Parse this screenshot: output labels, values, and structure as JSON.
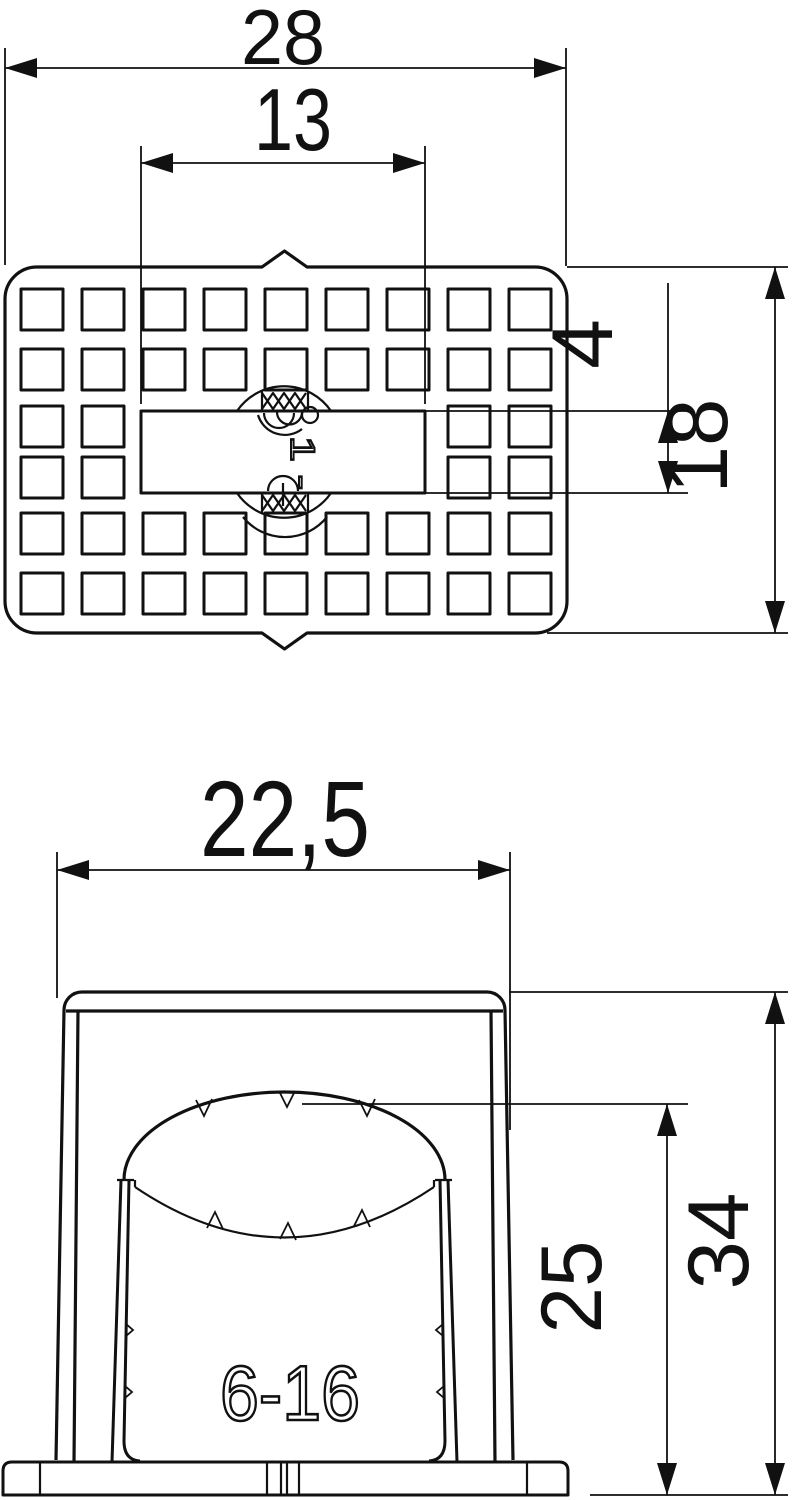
{
  "drawing": {
    "background": "#ffffff",
    "line_color": "#111111",
    "top_view": {
      "label": "plan view",
      "dim_width": "28",
      "dim_slot_length": "13",
      "dim_slot_height": "4",
      "dim_height": "18",
      "marking": "1 -",
      "grid": {
        "columns": 9,
        "rows": 6,
        "slot_columns": [
          2,
          3,
          4,
          5,
          6
        ],
        "slot_rows": [
          2,
          3
        ]
      }
    },
    "front_view": {
      "label": "front view",
      "dim_width": "22,5",
      "dim_opening_height": "25",
      "dim_height": "34",
      "marking": "6-16"
    }
  }
}
